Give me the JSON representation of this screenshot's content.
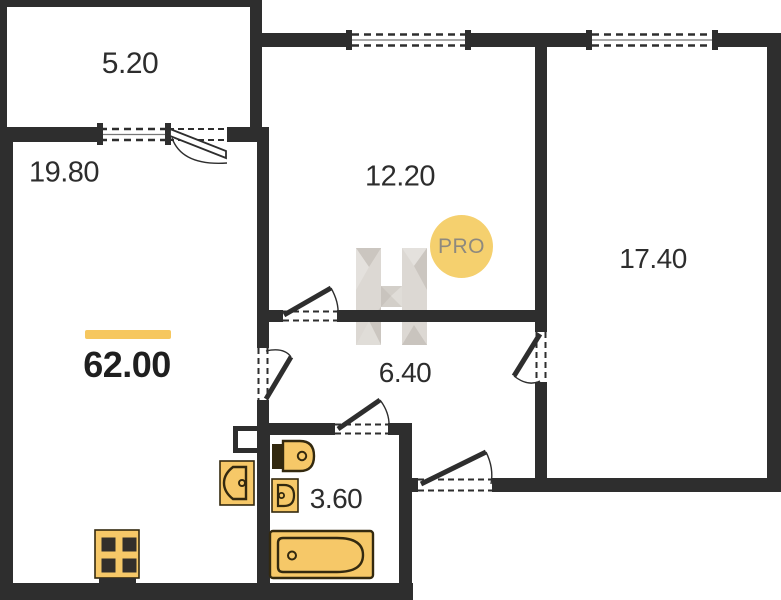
{
  "plan": {
    "total_area": "62.00",
    "badge_label": "PRO",
    "rooms": [
      {
        "id": "balcony",
        "area": "5.20"
      },
      {
        "id": "living-kitchen",
        "area": "19.80"
      },
      {
        "id": "room-top",
        "area": "12.20"
      },
      {
        "id": "room-right",
        "area": "17.40"
      },
      {
        "id": "hallway",
        "area": "6.40"
      },
      {
        "id": "bathroom",
        "area": "3.60"
      }
    ],
    "icons": {
      "watermark": "h-logo",
      "badge": "pro-badge",
      "fixtures": [
        "stove",
        "kitchen-sink",
        "toilet",
        "washbasin",
        "bathtub",
        "duct-shaft"
      ]
    },
    "colors": {
      "wall": "#2E2E2E",
      "fixture_fill": "#F6C868",
      "fixture_stroke": "#33290F",
      "accent_bar": "#F6C75F",
      "badge_bg": "#F5D06E",
      "badge_text": "#8E897E",
      "label_text": "#2D2D2D"
    }
  }
}
